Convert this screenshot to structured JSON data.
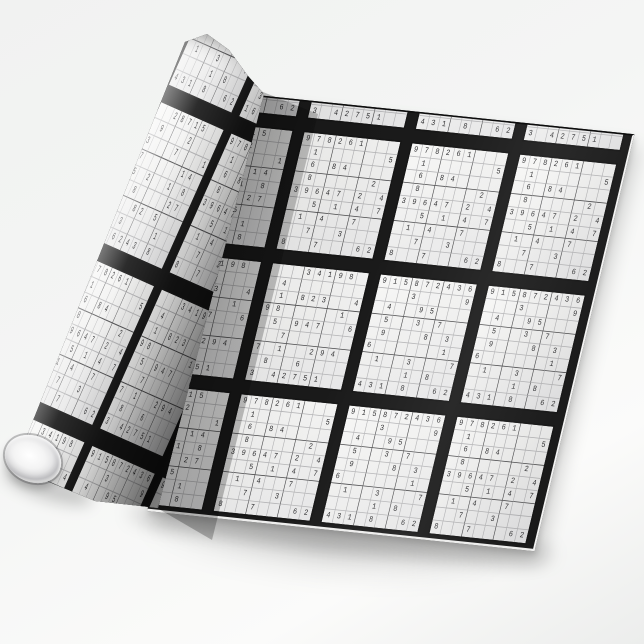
{
  "scene": {
    "description": "Product photo of a roll of wrapping paper printed with tiled black-and-white sudoku puzzles, partially unrolled diagonally on a white studio background; the rolled tube end is visible at the lower left.",
    "visible_text": "Only sudoku digits 1-9 printed on the paper; no other text."
  },
  "colors": {
    "background": "#f4f5f4",
    "separator_band": "#1a1a1a",
    "tile_paper": "#f7f7f6",
    "tile_paper_shaded": "#e6e6e7",
    "grid_line": "#b4b4b6",
    "box_line": "#4b4b4d",
    "tile_border": "#161616",
    "digit": "#2c2c2e",
    "tube": "#ffffff",
    "tube_rim": "#a9a9ac",
    "shadow": "rgba(0,0,0,0.17)"
  },
  "pattern": {
    "description": "9x9 sudoku grids with partially filled digits, each tile outlined in black, tiled edge-to-edge and separated by thick black bands",
    "sheet_tiling": [
      [
        "D",
        "C",
        "D",
        "C"
      ],
      [
        "B",
        "A",
        "A",
        "A"
      ],
      [
        "C",
        "C",
        "D",
        "D"
      ],
      [
        "B",
        "A",
        "D",
        "A"
      ]
    ],
    "roll_tiling": [
      [
        "A",
        "D",
        "B",
        "C"
      ],
      [
        "C",
        "B",
        "A",
        "D"
      ],
      [
        "D",
        "A",
        "C",
        "B"
      ],
      [
        "B",
        "C",
        "D",
        "A"
      ]
    ],
    "puzzles": {
      "A": [
        "978261...",
        ".1......5",
        ".6.84....",
        ".8.....2.",
        "39647.2.4",
        "..5.1.4.7",
        ".1.4..7..",
        "..7..3...",
        "8..7...62"
      ],
      "B": [
        "..28715..",
        ".9...2...",
        "3...7...1",
        "7.....14.",
        "5.2..1.8.",
        ".8....27.",
        "..82.5...",
        ".3....1..",
        "16243.8.."
      ],
      "C": [
        "...34198.",
        ".4.......",
        ".1.823..4",
        "98.....1.",
        ".5.947..6",
        "..7......",
        "7.1..294.",
        ".8..6....",
        "3.42751.."
      ],
      "D": [
        "915872436",
        "...3....9",
        ".4..95...",
        ".5..3.7..",
        ".9...8.3.",
        "6......1.",
        ".1..3...7",
        "....1.8..",
        "431.8..62"
      ]
    }
  }
}
